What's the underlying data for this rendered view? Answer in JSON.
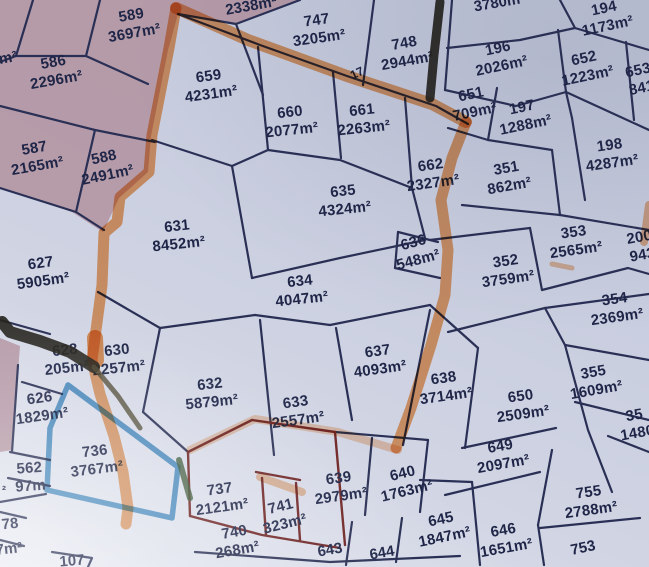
{
  "title": "Cadastral parcel map (photo) with highlighter annotations",
  "colors": {
    "paper": "#cdd2e2",
    "paper_pink": "#b2929f",
    "line": "#2a3055",
    "line_dark_red": "#6e2424",
    "text": "#1e2547",
    "orange_highlight": "#f0924a",
    "blue_highlight": "#3d8fc6",
    "black_marker": "#23211b",
    "olive_marker": "#4a4430",
    "green_marker": "#35512f"
  },
  "road_label": "17",
  "parcels": [
    {
      "num": "586",
      "area": "2296m²",
      "x": 55,
      "y": 72,
      "rot": -10
    },
    {
      "num": "589",
      "area": "3697m²",
      "x": 133,
      "y": 25,
      "rot": -10
    },
    {
      "num": "587",
      "area": "2165m²",
      "x": 36,
      "y": 158,
      "rot": -10
    },
    {
      "num": "588",
      "area": "2491m²",
      "x": 106,
      "y": 167,
      "rot": -12
    },
    {
      "num": "627",
      "area": "5905m²",
      "x": 42,
      "y": 273,
      "rot": -8
    },
    {
      "num": "659",
      "area": "4231m²",
      "x": 210,
      "y": 86,
      "rot": -8
    },
    {
      "num": "747",
      "area": "3205m²",
      "x": 318,
      "y": 30,
      "rot": -8
    },
    {
      "num": "748",
      "area": "2944m²",
      "x": 406,
      "y": 53,
      "rot": -10
    },
    {
      "num": "660",
      "area": "2077m²",
      "x": 291,
      "y": 122,
      "rot": -6
    },
    {
      "num": "661",
      "area": "2263m²",
      "x": 363,
      "y": 120,
      "rot": -6
    },
    {
      "num": "662",
      "area": "2327m²",
      "x": 432,
      "y": 175,
      "rot": -8
    },
    {
      "num": "635",
      "area": "4324m²",
      "x": 344,
      "y": 201,
      "rot": -6
    },
    {
      "num": "631",
      "area": "8452m²",
      "x": 178,
      "y": 236,
      "rot": -6
    },
    {
      "num": "634",
      "area": "4047m²",
      "x": 301,
      "y": 291,
      "rot": -6
    },
    {
      "num": "636",
      "area": "548m²",
      "x": 416,
      "y": 252,
      "rot": -15
    },
    {
      "num": "194",
      "area": "1173m²",
      "x": 606,
      "y": 18,
      "rot": -12
    },
    {
      "num": "196",
      "area": "2026m²",
      "x": 500,
      "y": 58,
      "rot": -12
    },
    {
      "num": "652",
      "area": "1223m²",
      "x": 586,
      "y": 68,
      "rot": -12
    },
    {
      "num": "653",
      "area": "841",
      "x": 640,
      "y": 80,
      "rot": -12
    },
    {
      "num": "651",
      "area": "709m²",
      "x": 473,
      "y": 104,
      "rot": -12
    },
    {
      "num": "197",
      "area": "1288m²",
      "x": 524,
      "y": 117,
      "rot": -12
    },
    {
      "num": "198",
      "area": "4287m²",
      "x": 611,
      "y": 155,
      "rot": -8
    },
    {
      "num": "351",
      "area": "862m²",
      "x": 508,
      "y": 178,
      "rot": -10
    },
    {
      "num": "353",
      "area": "2565m²",
      "x": 575,
      "y": 242,
      "rot": -8
    },
    {
      "num": "200",
      "area": "943",
      "x": 641,
      "y": 247,
      "rot": -10
    },
    {
      "num": "352",
      "area": "3759m²",
      "x": 507,
      "y": 271,
      "rot": -8
    },
    {
      "num": "354",
      "area": "2369m²",
      "x": 616,
      "y": 309,
      "rot": -8
    },
    {
      "num": "355",
      "area": "1609m²",
      "x": 595,
      "y": 382,
      "rot": -10
    },
    {
      "num": "35",
      "area": "1480",
      "x": 636,
      "y": 425,
      "rot": -10
    },
    {
      "num": "637",
      "area": "4093m²",
      "x": 379,
      "y": 361,
      "rot": -8
    },
    {
      "num": "638",
      "area": "3714m²",
      "x": 445,
      "y": 388,
      "rot": -8
    },
    {
      "num": "650",
      "area": "2509m²",
      "x": 522,
      "y": 406,
      "rot": -8
    },
    {
      "num": "630",
      "area": "2257m²",
      "x": 118,
      "y": 360,
      "rot": -6
    },
    {
      "num": "628",
      "area": "205m²",
      "x": 66,
      "y": 360,
      "rot": -6
    },
    {
      "num": "626",
      "area": "1829m²",
      "x": 41,
      "y": 408,
      "rot": -8
    },
    {
      "num": "562",
      "area": "97m",
      "x": 30,
      "y": 478,
      "rot": -4
    },
    {
      "num": "736",
      "area": "3767m²",
      "x": 96,
      "y": 461,
      "rot": -7
    },
    {
      "num": "632",
      "area": "5879m²",
      "x": 211,
      "y": 394,
      "rot": -6
    },
    {
      "num": "633",
      "area": "2557m²",
      "x": 297,
      "y": 412,
      "rot": -8
    },
    {
      "num": "737",
      "area": "2121m²",
      "x": 221,
      "y": 499,
      "rot": -8
    },
    {
      "num": "741",
      "area": "323m²",
      "x": 283,
      "y": 516,
      "rot": -14
    },
    {
      "num": "639",
      "area": "2979m²",
      "x": 340,
      "y": 488,
      "rot": -8
    },
    {
      "num": "640",
      "area": "1763m²",
      "x": 405,
      "y": 483,
      "rot": -14
    },
    {
      "num": "740",
      "area": "268m²",
      "x": 236,
      "y": 542,
      "rot": -10
    },
    {
      "num": "645",
      "area": "1847m²",
      "x": 443,
      "y": 529,
      "rot": -12
    },
    {
      "num": "646",
      "area": "1651m²",
      "x": 505,
      "y": 540,
      "rot": -10
    },
    {
      "num": "649",
      "area": "2097m²",
      "x": 502,
      "y": 456,
      "rot": -10
    },
    {
      "num": "755",
      "area": "2788m²",
      "x": 590,
      "y": 502,
      "rot": -8
    }
  ],
  "fragments": [
    {
      "text": "2338m²",
      "x": 251,
      "y": 6,
      "rot": -10
    },
    {
      "text": "3780m",
      "x": 497,
      "y": 3,
      "rot": -10
    },
    {
      "text": "m²",
      "x": 8,
      "y": 58,
      "rot": -10
    },
    {
      "text": "17",
      "x": 357,
      "y": 73,
      "rot": -25,
      "small": true
    },
    {
      "text": "643",
      "x": 330,
      "y": 550,
      "rot": -10
    },
    {
      "text": "644",
      "x": 382,
      "y": 553,
      "rot": -10
    },
    {
      "text": "753",
      "x": 583,
      "y": 548,
      "rot": -12
    },
    {
      "text": "78",
      "x": 10,
      "y": 524,
      "rot": -6
    },
    {
      "text": "7m²",
      "x": 9,
      "y": 549,
      "rot": -6
    },
    {
      "text": "²",
      "x": 4,
      "y": 490,
      "rot": 0,
      "small": true
    },
    {
      "text": "107",
      "x": 72,
      "y": 561,
      "rot": -5
    }
  ]
}
